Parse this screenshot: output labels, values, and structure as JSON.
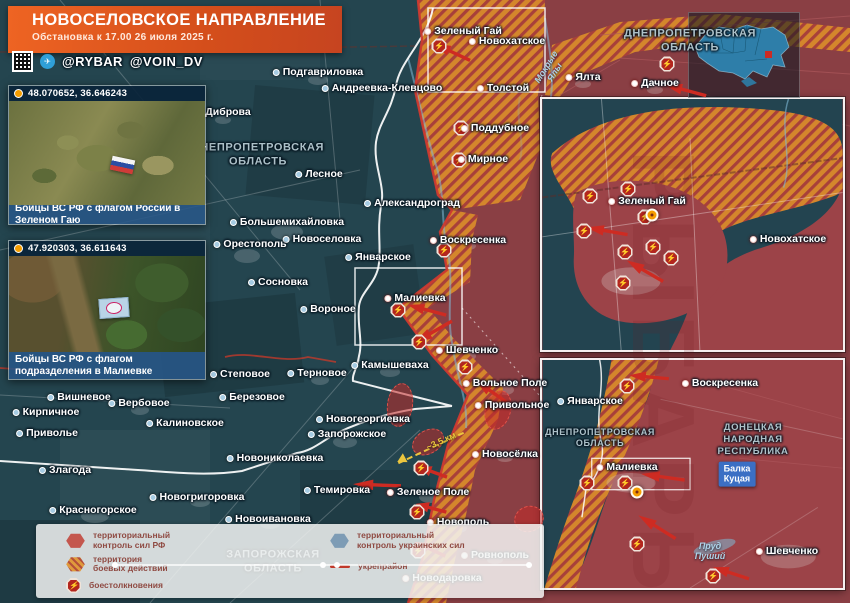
{
  "header": {
    "title": "НОВОСЕЛОВСКОЕ НАПРАВЛЕНИЕ",
    "subtitle": "Обстановка к 17.00 26 июля 2025 г.",
    "handle1": "@RYBAR",
    "handle2": "@VOIN_DV",
    "telegram_glyph": "✈"
  },
  "watermark": "РЫБАРЬ",
  "photos": [
    {
      "coords": "48.070652, 36.646243",
      "caption": "Бойцы ВС РФ с флагом России в Зеленом Гаю"
    },
    {
      "coords": "47.920303, 36.611643",
      "caption": "Бойцы ВС РФ с флагом подразделения в Малиевке"
    }
  ],
  "legend": {
    "items": [
      {
        "t": "территориальный\nконтроль сил РФ"
      },
      {
        "t": "территория\nбоевых действий"
      },
      {
        "t": "боестолкновения"
      },
      {
        "t": "территориальный\nконтроль украинских сил"
      },
      {
        "t": "укрепрайон"
      }
    ]
  },
  "map": {
    "distance_label": "~3,5 км",
    "balka": {
      "t": "Балка\nКуцая",
      "x": 737,
      "y": 474
    },
    "towns": [
      {
        "n": "Подгавриловка",
        "x": 318,
        "y": 72
      },
      {
        "n": "Андреевка-Клевцово",
        "x": 382,
        "y": 88
      },
      {
        "n": "Диброва",
        "x": 223,
        "y": 112
      },
      {
        "n": "Зеленый Гай",
        "x": 463,
        "y": 31,
        "red": true
      },
      {
        "n": "Новохатское",
        "x": 507,
        "y": 41,
        "red": true
      },
      {
        "n": "Толстой",
        "x": 503,
        "y": 88,
        "red": true
      },
      {
        "n": "Поддубное",
        "x": 495,
        "y": 128,
        "red": true
      },
      {
        "n": "Мирное",
        "x": 483,
        "y": 159,
        "red": true
      },
      {
        "n": "Ялта",
        "x": 583,
        "y": 77,
        "red": true
      },
      {
        "n": "Дачное",
        "x": 655,
        "y": 83,
        "red": true
      },
      {
        "n": "Лесное",
        "x": 319,
        "y": 174
      },
      {
        "n": "Александроград",
        "x": 412,
        "y": 203
      },
      {
        "n": "Большемихайловка",
        "x": 287,
        "y": 222
      },
      {
        "n": "Новоселовка",
        "x": 322,
        "y": 239
      },
      {
        "n": "Орестополь",
        "x": 250,
        "y": 244
      },
      {
        "n": "Январское",
        "x": 378,
        "y": 257
      },
      {
        "n": "Воскресенка",
        "x": 468,
        "y": 240,
        "red": true
      },
      {
        "n": "Сосновка",
        "x": 278,
        "y": 282
      },
      {
        "n": "Вороное",
        "x": 328,
        "y": 309
      },
      {
        "n": "Малиевка",
        "x": 415,
        "y": 298,
        "red": true
      },
      {
        "n": "Шевченко",
        "x": 467,
        "y": 350,
        "red": true
      },
      {
        "n": "Камышеваха",
        "x": 390,
        "y": 365
      },
      {
        "n": "Вольное Поле",
        "x": 505,
        "y": 383,
        "red": true
      },
      {
        "n": "Привольное",
        "x": 512,
        "y": 405,
        "red": true
      },
      {
        "n": "Степовое",
        "x": 240,
        "y": 374
      },
      {
        "n": "Терновое",
        "x": 317,
        "y": 373
      },
      {
        "n": "Вишневое",
        "x": 79,
        "y": 397
      },
      {
        "n": "Вербовое",
        "x": 139,
        "y": 403
      },
      {
        "n": "Березовое",
        "x": 252,
        "y": 397
      },
      {
        "n": "Кирпичное",
        "x": 46,
        "y": 412
      },
      {
        "n": "Приволье",
        "x": 47,
        "y": 433
      },
      {
        "n": "Калиновское",
        "x": 185,
        "y": 423
      },
      {
        "n": "Новогеоргиевка",
        "x": 363,
        "y": 419
      },
      {
        "n": "Запорожское",
        "x": 347,
        "y": 434
      },
      {
        "n": "Новониколаевка",
        "x": 275,
        "y": 458
      },
      {
        "n": "Злагода",
        "x": 65,
        "y": 470
      },
      {
        "n": "Новогригоровка",
        "x": 197,
        "y": 497
      },
      {
        "n": "Красногорское",
        "x": 93,
        "y": 510
      },
      {
        "n": "Темировка",
        "x": 337,
        "y": 490
      },
      {
        "n": "Новоивановка",
        "x": 268,
        "y": 519
      },
      {
        "n": "Новосёлка",
        "x": 505,
        "y": 454,
        "red": true
      },
      {
        "n": "Зеленое Поле",
        "x": 428,
        "y": 492,
        "red": true
      },
      {
        "n": "Новополь",
        "x": 458,
        "y": 522,
        "red": true
      },
      {
        "n": "Ровнополь",
        "x": 495,
        "y": 555,
        "red": true
      },
      {
        "n": "Новодаровка",
        "x": 442,
        "y": 578,
        "red": true
      },
      {
        "n": "Зеленый Гай",
        "x": 647,
        "y": 201,
        "red": true
      },
      {
        "n": "Новохатское",
        "x": 788,
        "y": 239,
        "red": true
      },
      {
        "n": "Январское",
        "x": 590,
        "y": 401
      },
      {
        "n": "Воскресенка",
        "x": 720,
        "y": 383,
        "red": true
      },
      {
        "n": "Малиевка",
        "x": 627,
        "y": 467,
        "red": true
      },
      {
        "n": "Шевченко",
        "x": 787,
        "y": 551,
        "red": true
      }
    ],
    "oblasts": [
      {
        "t": "ДНЕПРОПЕТРОВСКАЯ\nОБЛАСТЬ",
        "x": 258,
        "y": 155,
        "fs": 11
      },
      {
        "t": "ДНЕПРОПЕТРОВСКАЯ\nОБЛАСТЬ",
        "x": 690,
        "y": 41,
        "fs": 11
      },
      {
        "t": "ЗАПОРОЖСКАЯ\nОБЛАСТЬ",
        "x": 273,
        "y": 562,
        "fs": 11
      },
      {
        "t": "ДНЕПРОПЕТРОВСКАЯ\nОБЛАСТЬ",
        "x": 600,
        "y": 438,
        "fs": 9
      },
      {
        "t": "ДОНЕЦКАЯ\nНАРОДНАЯ\nРЕСПУБЛИКА",
        "x": 753,
        "y": 440,
        "fs": 9.5
      }
    ],
    "waters": [
      {
        "t": "Мокрые\nЯлы",
        "x": 551,
        "y": 70,
        "r": -58
      },
      {
        "t": "Пруд\nПуший",
        "x": 710,
        "y": 552,
        "r": 0
      }
    ],
    "battle_icons": [
      {
        "x": 439,
        "y": 46
      },
      {
        "x": 461,
        "y": 128
      },
      {
        "x": 459,
        "y": 160
      },
      {
        "x": 444,
        "y": 250
      },
      {
        "x": 398,
        "y": 310
      },
      {
        "x": 419,
        "y": 342
      },
      {
        "x": 465,
        "y": 367
      },
      {
        "x": 421,
        "y": 468
      },
      {
        "x": 417,
        "y": 512
      },
      {
        "x": 418,
        "y": 551
      },
      {
        "x": 667,
        "y": 64
      },
      {
        "x": 590,
        "y": 196
      },
      {
        "x": 628,
        "y": 189
      },
      {
        "x": 645,
        "y": 217
      },
      {
        "x": 653,
        "y": 247
      },
      {
        "x": 671,
        "y": 258
      },
      {
        "x": 625,
        "y": 252
      },
      {
        "x": 584,
        "y": 231
      },
      {
        "x": 623,
        "y": 283
      },
      {
        "x": 627,
        "y": 386
      },
      {
        "x": 587,
        "y": 483
      },
      {
        "x": 625,
        "y": 483
      },
      {
        "x": 637,
        "y": 544
      },
      {
        "x": 713,
        "y": 576
      }
    ],
    "photo_markers": [
      {
        "x": 652,
        "y": 215
      },
      {
        "x": 637,
        "y": 492
      }
    ],
    "arrows": [
      {
        "x": 685,
        "y": 90,
        "r": 195,
        "l": 44
      },
      {
        "x": 452,
        "y": 52,
        "r": 205,
        "l": 40
      },
      {
        "x": 427,
        "y": 310,
        "r": 195,
        "l": 40
      },
      {
        "x": 433,
        "y": 332,
        "r": 150,
        "l": 44
      },
      {
        "x": 492,
        "y": 392,
        "r": 215,
        "l": 40
      },
      {
        "x": 377,
        "y": 485,
        "r": 182,
        "l": 48
      },
      {
        "x": 433,
        "y": 472,
        "r": 200,
        "l": 30
      },
      {
        "x": 431,
        "y": 508,
        "r": 195,
        "l": 32
      },
      {
        "x": 430,
        "y": 549,
        "r": 205,
        "l": 34
      },
      {
        "x": 607,
        "y": 231,
        "r": 190,
        "l": 42
      },
      {
        "x": 645,
        "y": 271,
        "r": 210,
        "l": 42
      },
      {
        "x": 649,
        "y": 377,
        "r": 185,
        "l": 40
      },
      {
        "x": 663,
        "y": 477,
        "r": 188,
        "l": 44
      },
      {
        "x": 657,
        "y": 527,
        "r": 212,
        "l": 44
      },
      {
        "x": 731,
        "y": 573,
        "r": 198,
        "l": 38
      }
    ],
    "contested_zones": [
      {
        "x": 400,
        "y": 405,
        "w": 26,
        "h": 44,
        "r": 8
      },
      {
        "x": 428,
        "y": 442,
        "w": 34,
        "h": 24,
        "r": -30
      },
      {
        "x": 498,
        "y": 410,
        "w": 26,
        "h": 40,
        "r": 15
      },
      {
        "x": 529,
        "y": 519,
        "w": 30,
        "h": 26,
        "r": -20
      }
    ]
  },
  "colors": {
    "rf_zone": "#8a3f44",
    "combat_orange": "#d4862c",
    "combat_stripe": "#a8403a",
    "base_teal": "#24454f",
    "accent_red": "#ce2b22",
    "banner_orange": "#e05a1f",
    "ua_blue": "#7d9cb5"
  }
}
